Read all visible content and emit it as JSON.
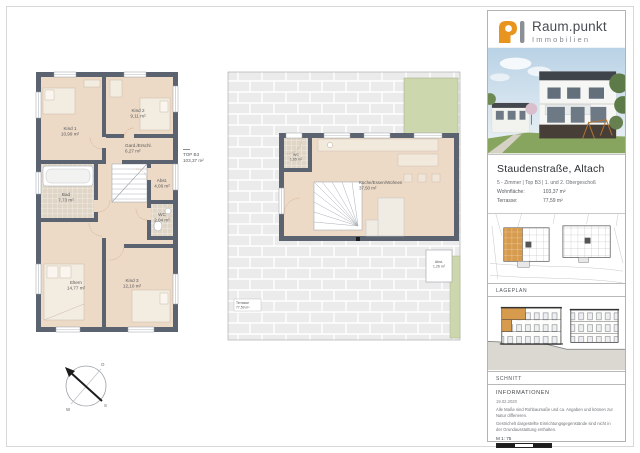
{
  "sidebar": {
    "brand": {
      "name": "Raum.punkt",
      "subtitle": "Immobilien"
    },
    "project": {
      "title": "Staudenstraße, Altach",
      "subtitle": "5 - Zimmer | Top B3 | 1. und 2. Obergeschoß",
      "fields": [
        {
          "label": "Wohnfläche:",
          "value": "103,37 m²"
        },
        {
          "label": "Terrasse:",
          "value": "77,59 m²"
        }
      ]
    },
    "sections": {
      "lageplan": "LAGEPLAN",
      "schnitt": "SCHNITT",
      "informationen": "INFORMATIONEN"
    },
    "info": {
      "date": "19.02.2020",
      "note1": "Alle Maße sind Rohbaumaße und ca. Angaben und können zur Natur differieren.",
      "note2": "Gestrichelt dargestellte Einrichtungsgegenstände sind nicht in der Grundausstattung enthalten.",
      "scale": "M 1: 75"
    }
  },
  "plan_upper": {
    "annotation": {
      "line1": "TOP B3",
      "line2": "103,37 m²"
    },
    "rooms": [
      {
        "name": "Kind 1",
        "area": "10,99 m²"
      },
      {
        "name": "Kind 2",
        "area": "9,11 m²"
      },
      {
        "name": "Gard./Erschl.",
        "area": "6,27 m²"
      },
      {
        "name": "Bad",
        "area": "7,73 m²"
      },
      {
        "name": "Abst.",
        "area": "4,06 m²"
      },
      {
        "name": "WC",
        "area": "2,04 m²"
      },
      {
        "name": "Eltern",
        "area": "14,77 m²"
      },
      {
        "name": "Kind 3",
        "area": "12,10 m²"
      }
    ]
  },
  "plan_terrace": {
    "rooms": [
      {
        "name": "Küche/Essen/Wohnen",
        "area": "37,50 m²"
      },
      {
        "name": "WC",
        "area": "1,65 m²"
      },
      {
        "name": "Abst.",
        "area": "1,26 m²"
      },
      {
        "name": "Terrasse",
        "area": "77,59 m²"
      }
    ]
  },
  "compass": {
    "o": "O",
    "s": "S",
    "w": "W"
  },
  "colors": {
    "brand_orange": "#e8951f",
    "wall": "#5b6370",
    "floor": "#ecd9c6",
    "highlight": "#d79b4e",
    "green": "#cdd7ae"
  }
}
